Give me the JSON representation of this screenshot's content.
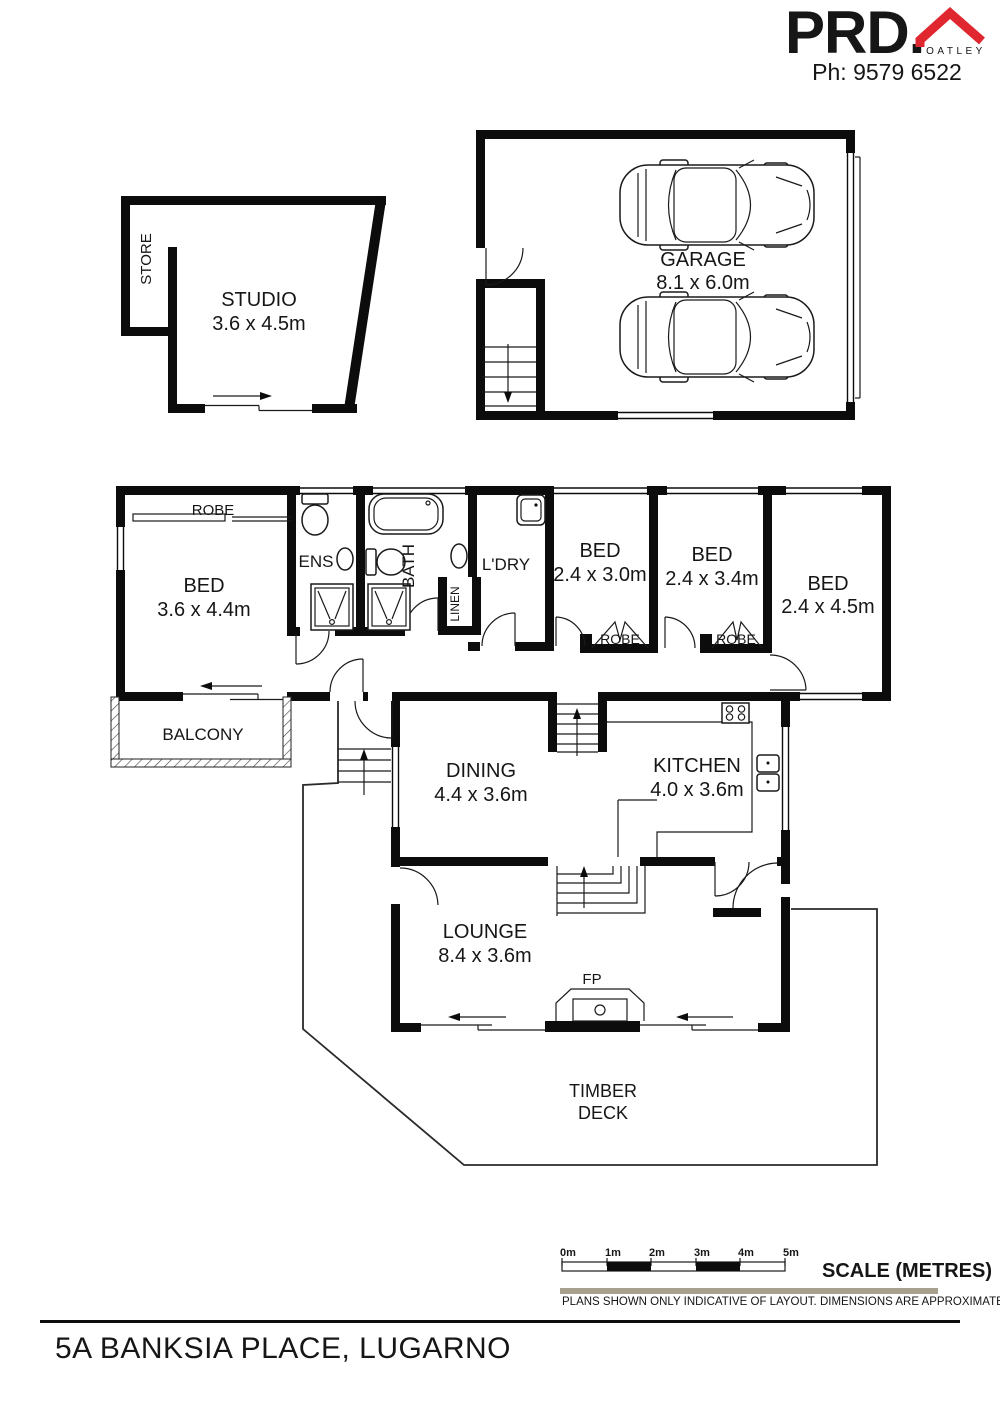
{
  "header": {
    "brand": "PRD.",
    "office": "OATLEY",
    "phone": "Ph: 9579 6522",
    "brand_color": "#e0262e",
    "muted_color": "#8d8d8d"
  },
  "floorplan": {
    "store": "STORE",
    "studio": {
      "label": "STUDIO",
      "dims": "3.6 x 4.5m"
    },
    "garage": {
      "label": "GARAGE",
      "dims": "8.1 x 6.0m"
    },
    "robe_main": "ROBE",
    "bed_main": {
      "label": "BED",
      "dims": "3.6 x 4.4m"
    },
    "ens": "ENS",
    "bath": "BATH",
    "linen": "LINEN",
    "ldry": "L'DRY",
    "bed2": {
      "label": "BED",
      "dims": "2.4 x 3.0m"
    },
    "robe2": "ROBE",
    "bed3": {
      "label": "BED",
      "dims": "2.4 x 3.4m"
    },
    "robe3": "ROBE",
    "bed4": {
      "label": "BED",
      "dims": "2.4 x 4.5m"
    },
    "balcony": "BALCONY",
    "dining": {
      "label": "DINING",
      "dims": "4.4 x 3.6m"
    },
    "kitchen": {
      "label": "KITCHEN",
      "dims": "4.0 x 3.6m"
    },
    "lounge": {
      "label": "LOUNGE",
      "dims": "8.4 x 3.6m"
    },
    "fp": "FP",
    "deck_line1": "TIMBER",
    "deck_line2": "DECK"
  },
  "scale_bar": {
    "ticks": [
      "0m",
      "1m",
      "2m",
      "3m",
      "4m",
      "5m"
    ],
    "title": "SCALE (METRES)",
    "disclaimer": "PLANS SHOWN ONLY INDICATIVE OF LAYOUT.  DIMENSIONS ARE APPROXIMATE.",
    "bar_color": "#a7a08f"
  },
  "address": "5A BANKSIA PLACE, LUGARNO"
}
